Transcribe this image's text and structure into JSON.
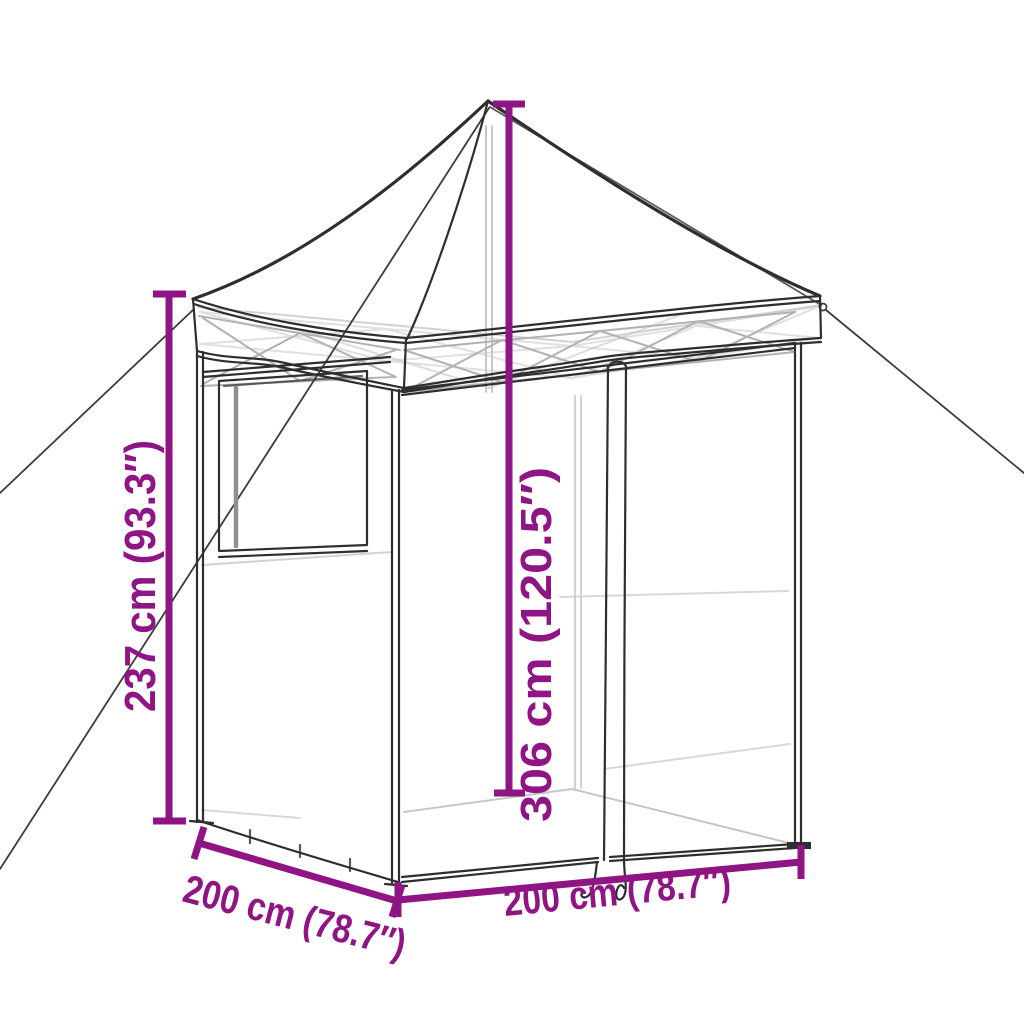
{
  "page": {
    "background": "#ffffff"
  },
  "diagram": {
    "kind": "product-dimension-line-drawing",
    "subject": "pop-up canopy party tent with sidewalls, window, zippered door and guy ropes",
    "colors": {
      "dimension_accent": "#8E1583",
      "drawing_outline": "#2E2E2E",
      "drawing_frame_light": "#C7C7C7",
      "background": "#FFFFFF"
    },
    "dimensions": {
      "side_height": {
        "label": "237 cm (93.3″)",
        "cm": "237 cm",
        "inches": "93.3″",
        "orientation": "vertical-left"
      },
      "peak_height": {
        "label": "306 cm (120.5″)",
        "cm": "306 cm",
        "inches": "120.5″",
        "orientation": "vertical-center"
      },
      "depth": {
        "label": "200 cm (78.7″)",
        "cm": "200 cm",
        "inches": "78.7″",
        "orientation": "diagonal-bottom-left"
      },
      "width": {
        "label": "200 cm (78.7″)",
        "cm": "200 cm",
        "inches": "78.7″",
        "orientation": "bottom-front"
      }
    }
  }
}
